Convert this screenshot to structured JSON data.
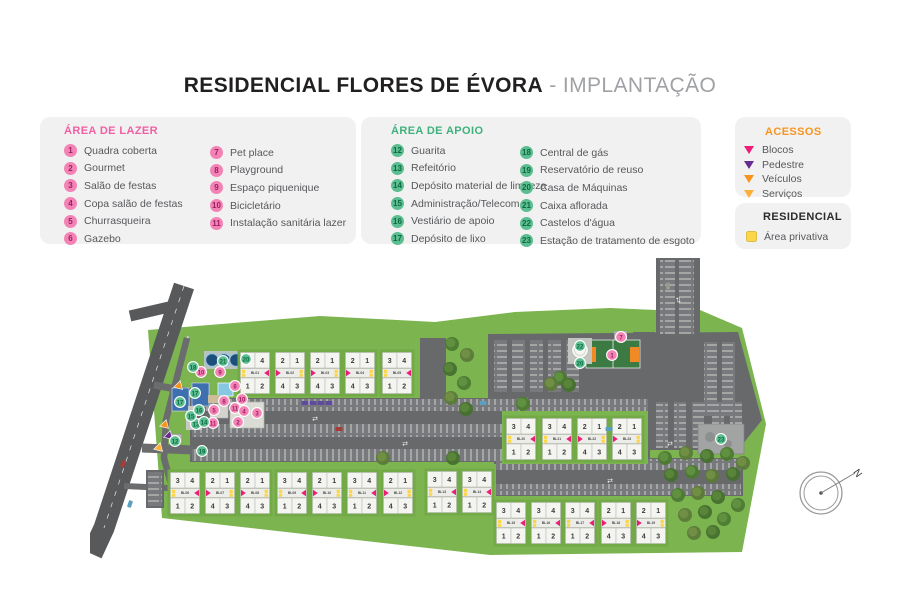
{
  "title": {
    "main": "RESIDENCIAL FLORES DE ÉVORA",
    "separator": " - ",
    "subtitle": "IMPLANTAÇÃO"
  },
  "legends": {
    "lazer": {
      "header": "ÁREA DE LAZER",
      "col1": [
        {
          "n": "1",
          "label": "Quadra coberta"
        },
        {
          "n": "2",
          "label": "Gourmet"
        },
        {
          "n": "3",
          "label": "Salão de festas"
        },
        {
          "n": "4",
          "label": "Copa salão de festas"
        },
        {
          "n": "5",
          "label": "Churrasqueira"
        },
        {
          "n": "6",
          "label": "Gazebo"
        }
      ],
      "col2": [
        {
          "n": "7",
          "label": "Pet place"
        },
        {
          "n": "8",
          "label": "Playground"
        },
        {
          "n": "9",
          "label": "Espaço piquenique"
        },
        {
          "n": "10",
          "label": "Bicicletário"
        },
        {
          "n": "11",
          "label": "Instalação sanitária lazer"
        }
      ]
    },
    "apoio": {
      "header": "ÁREA DE APOIO",
      "col1": [
        {
          "n": "12",
          "label": "Guarita"
        },
        {
          "n": "13",
          "label": "Refeitório"
        },
        {
          "n": "14",
          "label": "Depósito material de limpeza"
        },
        {
          "n": "15",
          "label": "Administração/Telecom"
        },
        {
          "n": "16",
          "label": "Vestiário de apoio"
        },
        {
          "n": "17",
          "label": "Depósito de lixo"
        }
      ],
      "col2": [
        {
          "n": "18",
          "label": "Central de gás"
        },
        {
          "n": "19",
          "label": "Reservatório de reuso"
        },
        {
          "n": "20",
          "label": "Casa de Máquinas"
        },
        {
          "n": "21",
          "label": "Caixa aflorada"
        },
        {
          "n": "22",
          "label": "Castelos d'água"
        },
        {
          "n": "23",
          "label": "Estação de tratamento de esgoto"
        }
      ]
    },
    "acessos": {
      "header": "ACESSOS",
      "items": [
        {
          "label": "Blocos",
          "key": "blocos"
        },
        {
          "label": "Pedestre",
          "key": "pedestre"
        },
        {
          "label": "Veículos",
          "key": "veiculos"
        },
        {
          "label": "Serviços",
          "key": "servicos"
        }
      ]
    },
    "residencial": {
      "header": "RESIDENCIAL",
      "items": [
        {
          "label": "Área privativa",
          "key": "privativa"
        }
      ]
    }
  },
  "colors": {
    "lazer_header": "#f05fa3",
    "lazer_badge": "#f283b4",
    "lazer_badge_text": "#9e1f63",
    "apoio_header": "#3eb27c",
    "apoio_badge": "#5cbd90",
    "apoio_badge_text": "#0d6b42",
    "acessos_header": "#f7941e",
    "residencial_header": "#2b2b2b",
    "blocos": "#ec1e79",
    "pedestre": "#662d91",
    "veiculos": "#f7941e",
    "servicos": "#fbb03b",
    "privativa": "#fcd648",
    "grass": "#7cb450",
    "grass_pad": "#73aa48",
    "asphalt": "#67696b",
    "road": "#58595b",
    "strip": "#77797c",
    "block_fill": "#f4f4f1",
    "block_stroke": "#b9b9b5",
    "block_band": "#ecece9"
  },
  "map": {
    "block_numbers": {
      "A": [
        "3",
        "4",
        "1",
        "2"
      ],
      "B": [
        "2",
        "1",
        "4",
        "3"
      ]
    },
    "blocks": [
      {
        "id": "BL01",
        "x": 150,
        "y": 100,
        "p": "A"
      },
      {
        "id": "BL02",
        "x": 185,
        "y": 100,
        "p": "B"
      },
      {
        "id": "BL03",
        "x": 220,
        "y": 100,
        "p": "B"
      },
      {
        "id": "BL04",
        "x": 255,
        "y": 100,
        "p": "B"
      },
      {
        "id": "BL05",
        "x": 292,
        "y": 100,
        "p": "A"
      },
      {
        "id": "BL06",
        "x": 80,
        "y": 220,
        "p": "A"
      },
      {
        "id": "BL07",
        "x": 115,
        "y": 220,
        "p": "B"
      },
      {
        "id": "BL08",
        "x": 150,
        "y": 220,
        "p": "B"
      },
      {
        "id": "BL09",
        "x": 187,
        "y": 220,
        "p": "A"
      },
      {
        "id": "BL10",
        "x": 222,
        "y": 220,
        "p": "B"
      },
      {
        "id": "BL11",
        "x": 257,
        "y": 220,
        "p": "A"
      },
      {
        "id": "BL12",
        "x": 293,
        "y": 220,
        "p": "B"
      },
      {
        "id": "BL13",
        "x": 337,
        "y": 219,
        "p": "A"
      },
      {
        "id": "BL14",
        "x": 372,
        "y": 219,
        "p": "A"
      },
      {
        "id": "BL15",
        "x": 406,
        "y": 250,
        "p": "A"
      },
      {
        "id": "BL16",
        "x": 441,
        "y": 250,
        "p": "A"
      },
      {
        "id": "BL17",
        "x": 475,
        "y": 250,
        "p": "A"
      },
      {
        "id": "BL18",
        "x": 511,
        "y": 250,
        "p": "B"
      },
      {
        "id": "BL19",
        "x": 546,
        "y": 250,
        "p": "B"
      },
      {
        "id": "BL20",
        "x": 416,
        "y": 166,
        "p": "A"
      },
      {
        "id": "BL21",
        "x": 452,
        "y": 166,
        "p": "A"
      },
      {
        "id": "BL22",
        "x": 487,
        "y": 166,
        "p": "B"
      },
      {
        "id": "BL23",
        "x": 522,
        "y": 166,
        "p": "B"
      }
    ],
    "markers": [
      {
        "n": "1",
        "kind": "lazer",
        "x": 522,
        "y": 103
      },
      {
        "n": "7",
        "kind": "lazer",
        "x": 531,
        "y": 85
      },
      {
        "n": "9",
        "kind": "lazer",
        "x": 130,
        "y": 120
      },
      {
        "n": "10",
        "kind": "lazer",
        "x": 111,
        "y": 120
      },
      {
        "n": "10",
        "kind": "lazer",
        "x": 152,
        "y": 147
      },
      {
        "n": "6",
        "kind": "lazer",
        "x": 145,
        "y": 134
      },
      {
        "n": "8",
        "kind": "lazer",
        "x": 134,
        "y": 149
      },
      {
        "n": "5",
        "kind": "lazer",
        "x": 124,
        "y": 158
      },
      {
        "n": "11",
        "kind": "lazer",
        "x": 123,
        "y": 171
      },
      {
        "n": "11",
        "kind": "lazer",
        "x": 145,
        "y": 156
      },
      {
        "n": "4",
        "kind": "lazer",
        "x": 154,
        "y": 159
      },
      {
        "n": "2",
        "kind": "lazer",
        "x": 148,
        "y": 170
      },
      {
        "n": "3",
        "kind": "lazer",
        "x": 167,
        "y": 161
      },
      {
        "n": "12",
        "kind": "apoio",
        "x": 85,
        "y": 189
      },
      {
        "n": "13",
        "kind": "apoio",
        "x": 106,
        "y": 172
      },
      {
        "n": "14",
        "kind": "apoio",
        "x": 114,
        "y": 170
      },
      {
        "n": "15",
        "kind": "apoio",
        "x": 101,
        "y": 164
      },
      {
        "n": "16",
        "kind": "apoio",
        "x": 109,
        "y": 158
      },
      {
        "n": "17",
        "kind": "apoio",
        "x": 90,
        "y": 150
      },
      {
        "n": "17",
        "kind": "apoio",
        "x": 105,
        "y": 141
      },
      {
        "n": "18",
        "kind": "apoio",
        "x": 103,
        "y": 115
      },
      {
        "n": "19",
        "kind": "apoio",
        "x": 112,
        "y": 199
      },
      {
        "n": "20",
        "kind": "apoio",
        "x": 156,
        "y": 107
      },
      {
        "n": "21",
        "kind": "apoio",
        "x": 133,
        "y": 109
      },
      {
        "n": "22",
        "kind": "apoio",
        "x": 490,
        "y": 94
      },
      {
        "n": "20",
        "kind": "apoio",
        "x": 490,
        "y": 111
      },
      {
        "n": "23",
        "kind": "apoio",
        "x": 631,
        "y": 187
      }
    ],
    "access_points": [
      {
        "key": "veiculos",
        "x": 88,
        "y": 134,
        "rot": 75
      },
      {
        "key": "veiculos",
        "x": 74,
        "y": 173,
        "rot": 75
      },
      {
        "key": "pedestre",
        "x": 78,
        "y": 184,
        "rot": 75
      },
      {
        "key": "servicos",
        "x": 68,
        "y": 196,
        "rot": 75
      }
    ],
    "trees": [
      [
        362,
        92
      ],
      [
        377,
        103
      ],
      [
        360,
        117
      ],
      [
        374,
        131
      ],
      [
        361,
        146
      ],
      [
        376,
        157
      ],
      [
        470,
        126
      ],
      [
        461,
        132
      ],
      [
        479,
        133
      ],
      [
        575,
        206
      ],
      [
        596,
        201
      ],
      [
        617,
        204
      ],
      [
        637,
        202
      ],
      [
        653,
        211
      ],
      [
        581,
        223
      ],
      [
        602,
        220
      ],
      [
        622,
        224
      ],
      [
        643,
        222
      ],
      [
        588,
        243
      ],
      [
        608,
        241
      ],
      [
        628,
        245
      ],
      [
        648,
        253
      ],
      [
        595,
        263
      ],
      [
        615,
        260
      ],
      [
        634,
        267
      ],
      [
        604,
        281
      ],
      [
        623,
        280
      ],
      [
        98,
        232
      ],
      [
        293,
        206
      ],
      [
        363,
        206
      ],
      [
        433,
        152
      ]
    ],
    "cars": [
      {
        "x": 215,
        "y": 151,
        "c": "#5e4a9e"
      },
      {
        "x": 223,
        "y": 151,
        "c": "#5e4a9e"
      },
      {
        "x": 231,
        "y": 151,
        "c": "#5e4a9e"
      },
      {
        "x": 239,
        "y": 151,
        "c": "#5e4a9e"
      },
      {
        "x": 249,
        "y": 177,
        "c": "#a83a3a"
      },
      {
        "x": 393,
        "y": 151,
        "c": "#5a9fc0"
      },
      {
        "x": 519,
        "y": 177,
        "c": "#5a9fc0"
      },
      {
        "x": 578,
        "y": 34,
        "c": "#98988f",
        "rot": 90
      },
      {
        "x": 33,
        "y": 212,
        "c": "#a83a3a",
        "rot": -71
      },
      {
        "x": 40,
        "y": 252,
        "c": "#5a9fc0",
        "rot": -71
      }
    ]
  },
  "compass": {
    "label": "N"
  }
}
